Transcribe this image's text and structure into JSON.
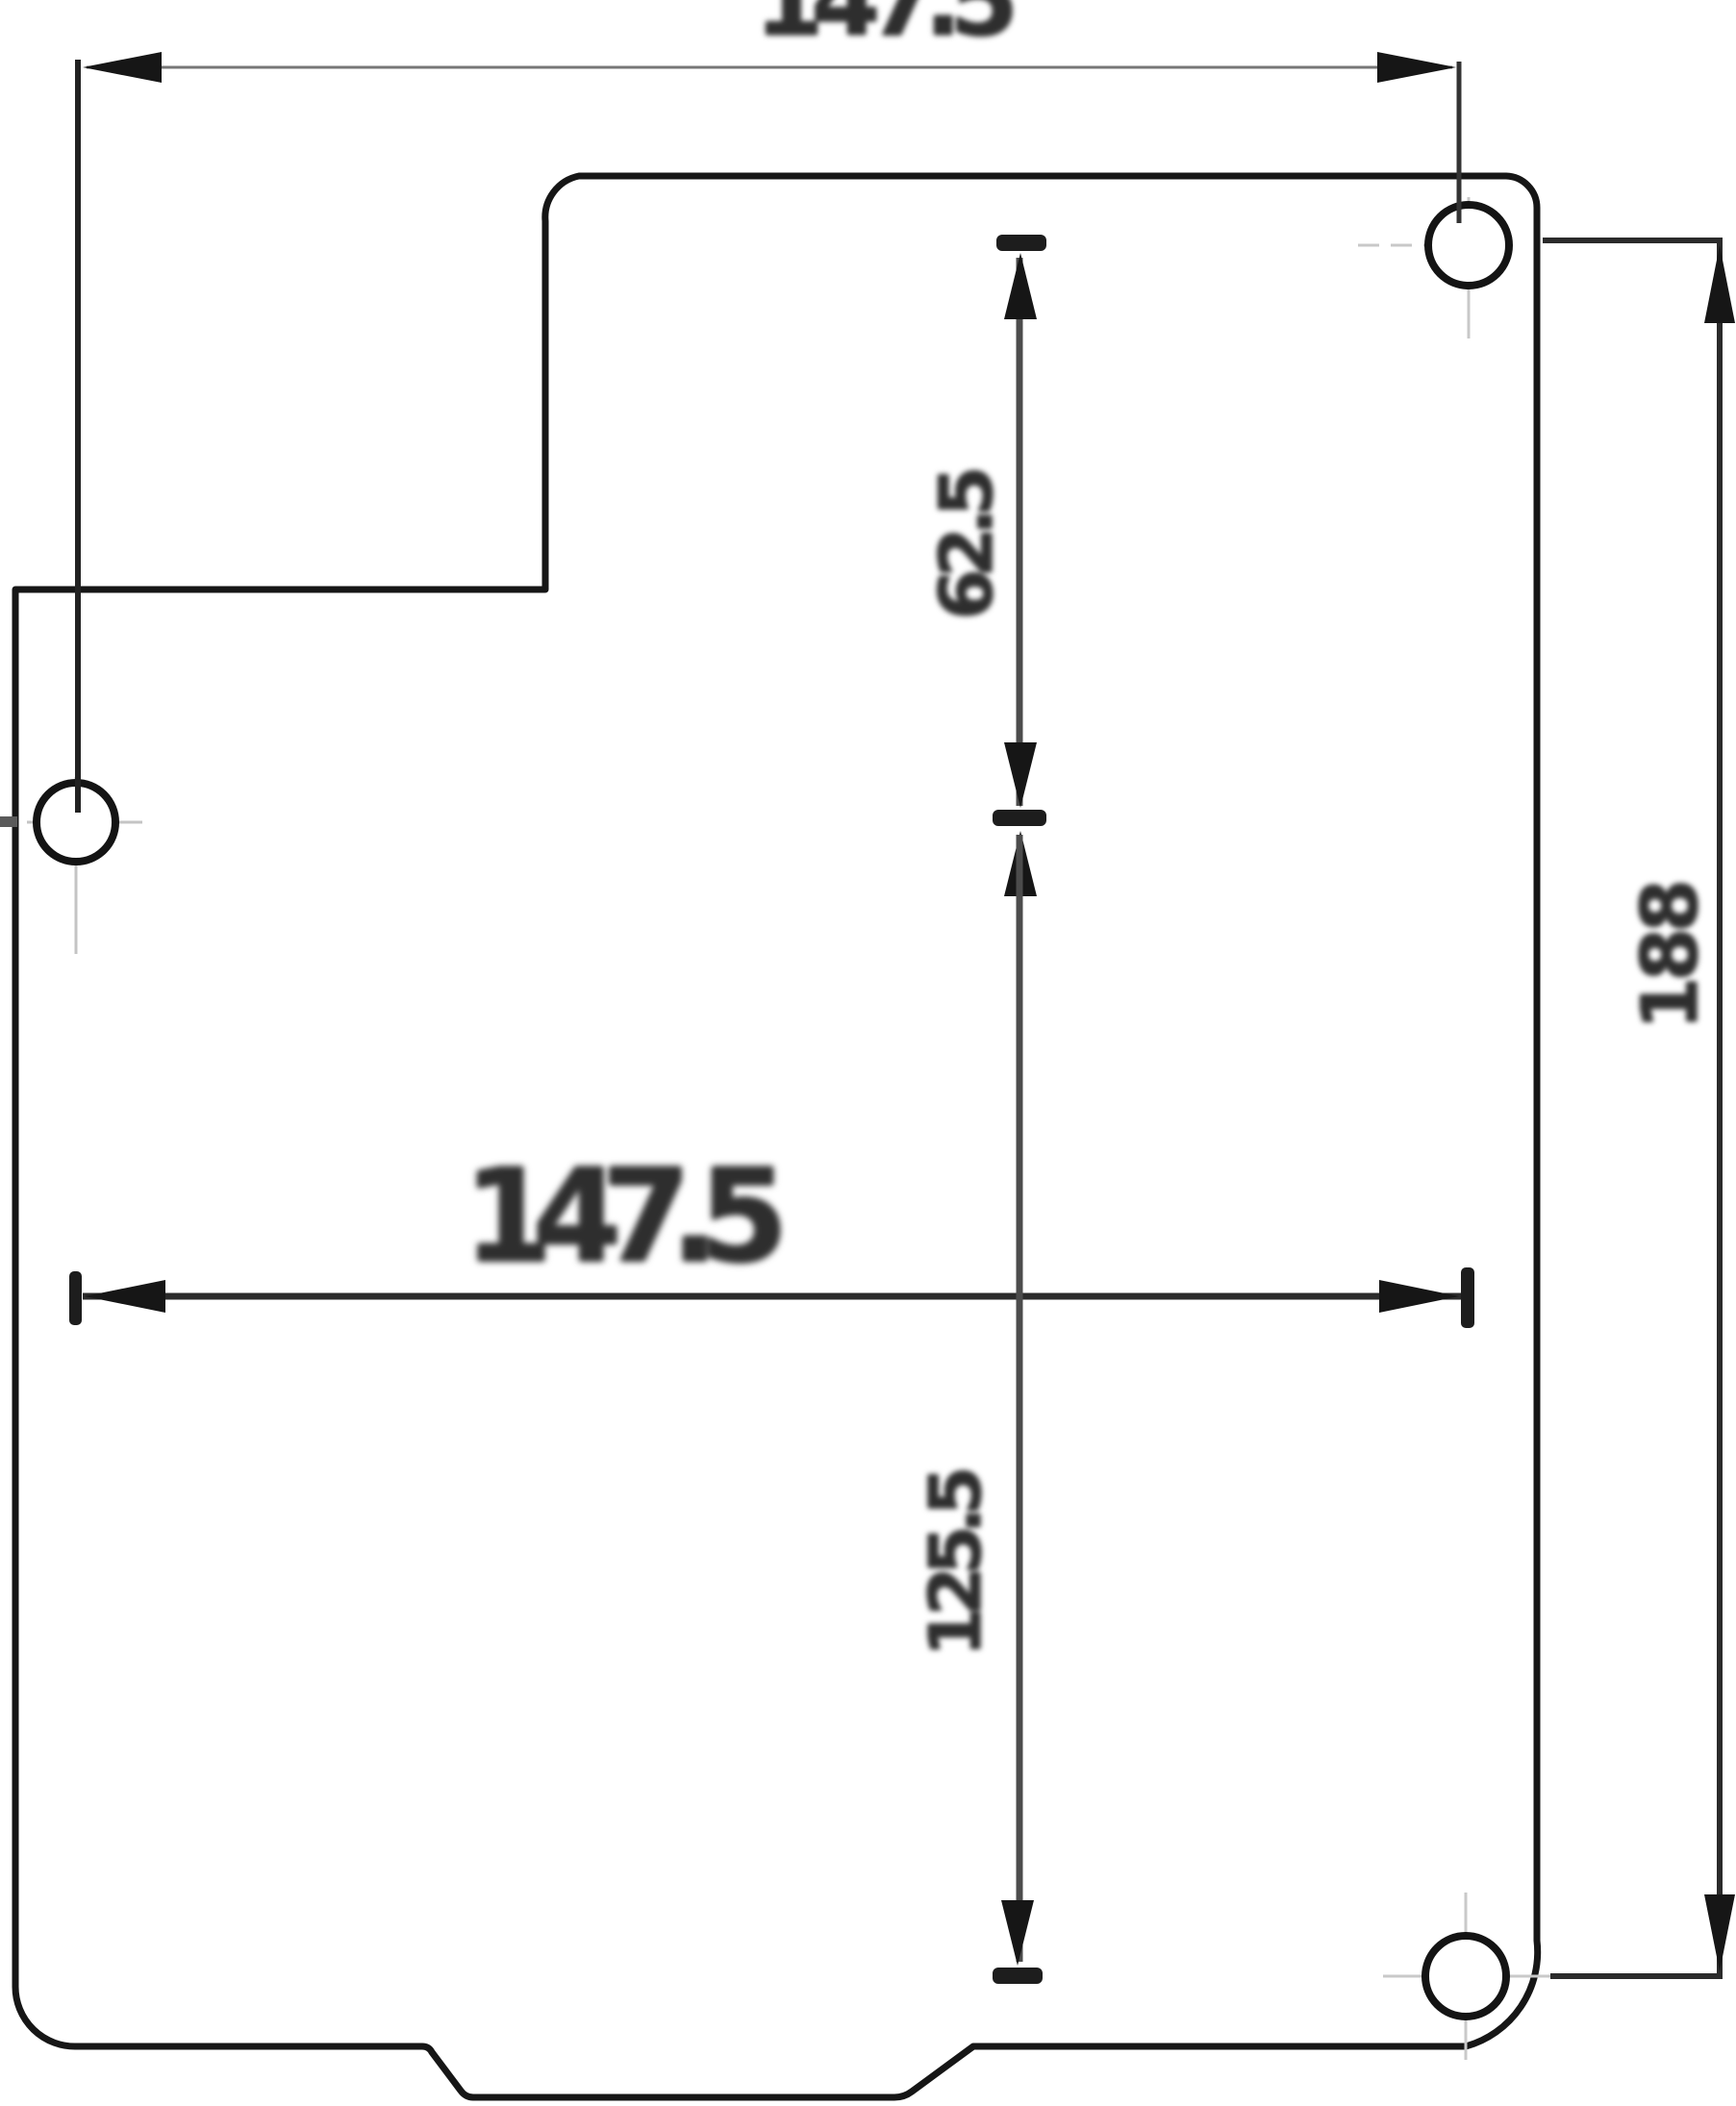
{
  "drawing": {
    "title": "Plate dimension drawing (scanned engineering diagram)",
    "part": "stepped mounting plate with notched top-left corner and bottom tab",
    "dimensions": {
      "top_width": {
        "label": "147.5",
        "orientation": "horizontal",
        "measures": "left hole center to top-right hole center"
      },
      "center_width": {
        "label": "147.5",
        "orientation": "horizontal",
        "measures": "left hole center to bottom-right hole center"
      },
      "upper_height": {
        "label": "62.5",
        "orientation": "vertical",
        "measures": "top-right hole center line to left hole center line"
      },
      "lower_height": {
        "label": "125.5",
        "orientation": "vertical",
        "measures": "left hole center line to bottom-right hole center line"
      },
      "right_height": {
        "label": "188",
        "orientation": "vertical",
        "measures": "top-right hole center to bottom-right hole center"
      }
    },
    "holes": {
      "count": 3,
      "positions": [
        "left-middle",
        "top-right",
        "bottom-right"
      ]
    },
    "colors": {
      "outline": "#161616",
      "dim_line": "#2b2b2b",
      "dim_line_light": "#777777",
      "label": "#2e2e2e",
      "centerline": "#c4c4c4",
      "background": "#ffffff"
    }
  }
}
